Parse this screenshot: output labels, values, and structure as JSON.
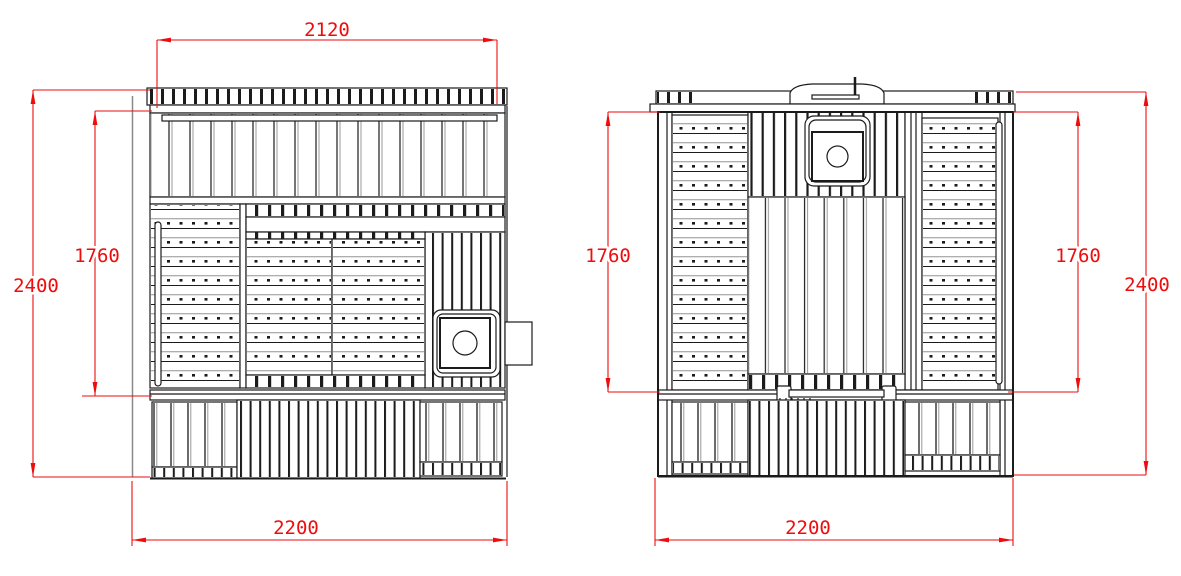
{
  "colors": {
    "line": "#1b1b1b",
    "dimension": "#ee0c0c",
    "background": "#ffffff"
  },
  "views": {
    "left": {
      "dims": {
        "top_width": "2120",
        "overall_height": "2400",
        "interior_height": "1760",
        "base_width": "2200"
      }
    },
    "right": {
      "dims": {
        "interior_height_left": "1760",
        "interior_height_right": "1760",
        "overall_height": "2400",
        "base_width": "2200"
      }
    }
  }
}
